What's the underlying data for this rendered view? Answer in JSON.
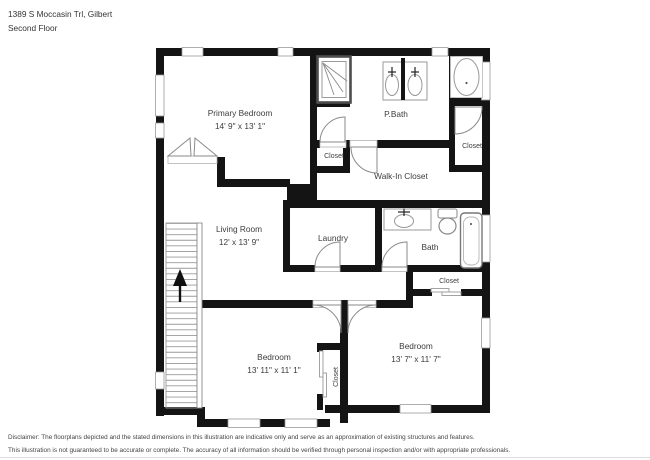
{
  "header": {
    "address": "1389 S Moccasin Trl, Gilbert",
    "floor": "Second Floor"
  },
  "rooms": {
    "primary": {
      "name": "Primary Bedroom",
      "dims": "14' 9\" x 13' 1\""
    },
    "pbath": {
      "name": "P.Bath"
    },
    "pbath_closet": {
      "name": "Closet"
    },
    "tr_closet": {
      "name": "Closet"
    },
    "walk_in": {
      "name": "Walk-In Closet"
    },
    "living": {
      "name": "Living Room",
      "dims": "12' x 13' 9\""
    },
    "laundry": {
      "name": "Laundry"
    },
    "bath": {
      "name": "Bath"
    },
    "hall_closet": {
      "name": "Closet"
    },
    "bedroom_left": {
      "name": "Bedroom",
      "dims": "13' 11\" x 11' 1\""
    },
    "mid_closet": {
      "name": "Closet"
    },
    "bedroom_right": {
      "name": "Bedroom",
      "dims": "13' 7\" x 11' 7\""
    }
  },
  "disclaimer": {
    "line1": "Disclaimer: The floorplans depicted and the stated dimensions in this illustration are indicative only and serve as an approximation of existing structures and features.",
    "line2": "This illustration is not guaranteed to be accurate or complete. The accuracy of all information should be verified through personal inspection and/or with appropriate professionals."
  },
  "colors": {
    "wall": "#141414",
    "fixture": "#999999",
    "text": "#3c3c3c"
  }
}
